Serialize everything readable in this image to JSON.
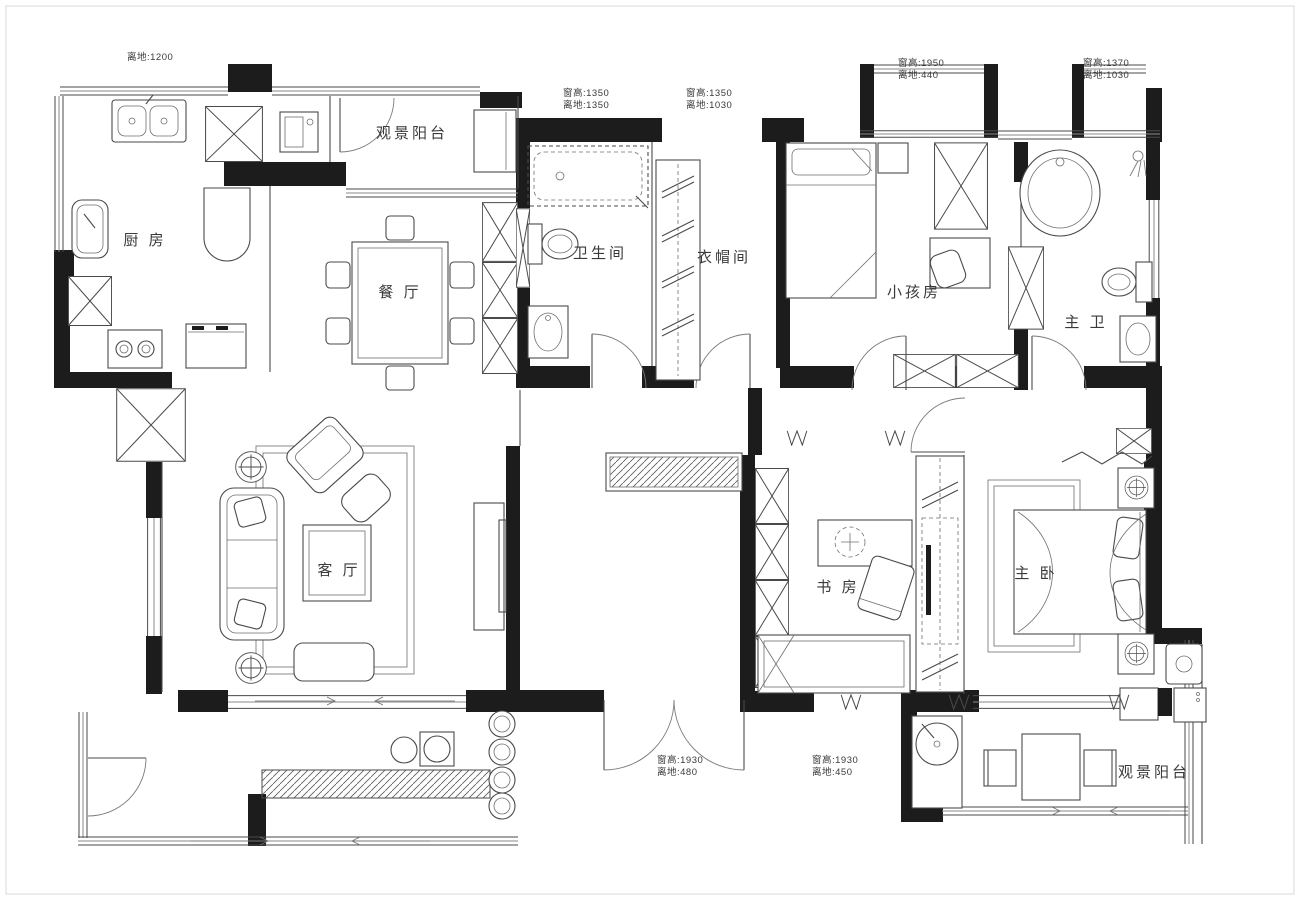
{
  "drawing": {
    "type": "apartment-floor-plan",
    "rooms": {
      "balcony_top": {
        "label": "观景阳台"
      },
      "kitchen": {
        "label": "厨 房"
      },
      "dining": {
        "label": "餐 厅"
      },
      "bathroom": {
        "label": "卫生间"
      },
      "cloakroom": {
        "label": "衣帽间"
      },
      "kids_room": {
        "label": "小孩房"
      },
      "master_bath": {
        "label": "主 卫"
      },
      "living": {
        "label": "客 厅"
      },
      "study": {
        "label": "书 房"
      },
      "master_bed": {
        "label": "主 卧"
      },
      "balcony_br": {
        "label": "观景阳台"
      }
    },
    "annotations": {
      "a1": {
        "l1": "离地:1200",
        "l2": ""
      },
      "a2": {
        "l1": "窗高:1350",
        "l2": "离地:1350"
      },
      "a3": {
        "l1": "窗高:1350",
        "l2": "离地:1030"
      },
      "a4": {
        "l1": "窗高:1950",
        "l2": "离地:440"
      },
      "a5": {
        "l1": "窗高:1370",
        "l2": "离地:1030"
      },
      "a6": {
        "l1": "窗高:1930",
        "l2": "离地:480"
      },
      "a7": {
        "l1": "窗高:1930",
        "l2": "离地:450"
      }
    },
    "colors": {
      "wall": "#1c1c1c",
      "line": "#4a4a4a",
      "light_line": "#6f6f6f",
      "text": "#3a3a3a",
      "background": "#ffffff"
    }
  }
}
